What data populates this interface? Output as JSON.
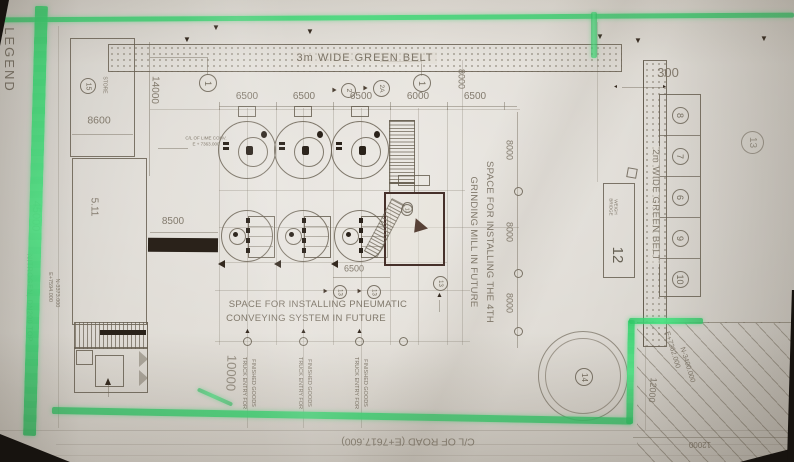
{
  "labels": {
    "legend": "LEGEND",
    "belt_top": "3m WIDE GREEN BELT",
    "belt_right": "2m WIDE GREEN BELT",
    "mill_space_1": "SPACE FOR INSTALLING THE 4TH",
    "mill_space_2": "GRINDING MILL IN FUTURE",
    "pneumatic_1": "SPACE FOR INSTALLING PNEUMATIC",
    "pneumatic_2": "CONVEYING SYSTEM IN FUTURE",
    "nitrogen": "NITROGEN, DN200 TOP",
    "cl_road": "C/L OF ROAD (E+7617.600)",
    "cl_conveyor_1": "C/L OF LIME CONV.",
    "cl_conveyor_2": "E + 7363.000",
    "weigh_1": "WEIGH",
    "weigh_2": "BRIDGE",
    "weigh_no": "12",
    "store": "STORE",
    "store_no": "15",
    "room_no": "5.11",
    "truck_line_1": "TRUCK ENTRY FOR",
    "truck_line_2": "FINISHED GOODS",
    "coord_e_left": "E+7594.000",
    "coord_n_left": "N-3373.000",
    "coord_e_br": "E+7362.000",
    "coord_n_br": "N-3400.000",
    "tank_no": "14"
  },
  "dims": {
    "top_row": [
      "6500",
      "6500",
      "6500",
      "6000",
      "6500"
    ],
    "belt_width": "300",
    "bay_depth": "8000",
    "site_length": "45000",
    "store_length": "14000",
    "store_width": "8600",
    "conveyor": "8500",
    "road_offset": "10000",
    "bay_width": "6500",
    "road_width": "12000"
  },
  "bubbles": {
    "grid_1": "1",
    "grid_2": "1",
    "sec_2": "2",
    "sec_2a": "2A",
    "tag_13": "13"
  },
  "plot_cells": [
    "8",
    "7",
    "6",
    "9",
    "10"
  ]
}
